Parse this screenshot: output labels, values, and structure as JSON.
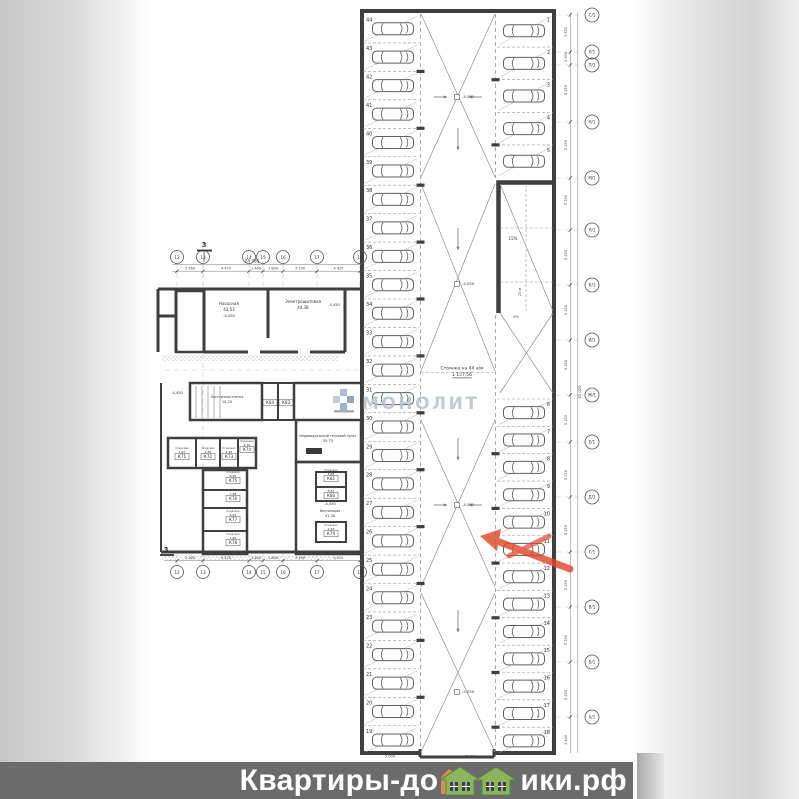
{
  "watermark": {
    "brand": "МОНОЛИТ"
  },
  "footer": {
    "site_prefix": "Квартиры-до",
    "site_suffix": "ики.рф",
    "site_name": "Квартиры-домики.рф"
  },
  "parking": {
    "caption": "Стоянка на 44 а/м",
    "caption_area": "1 157,56",
    "aisle_elevation": "-4,050",
    "left_stalls": [
      44,
      43,
      42,
      41,
      40,
      39,
      38,
      37,
      36,
      35,
      34,
      33,
      32,
      31,
      30,
      29,
      28,
      27,
      26,
      25,
      24,
      23,
      22,
      21,
      20,
      19
    ],
    "right_top_stalls": [
      1,
      2,
      3,
      4,
      5
    ],
    "right_bottom_stalls": [
      6,
      7,
      8,
      9,
      10,
      11,
      12,
      13,
      14,
      15,
      16,
      17,
      18
    ],
    "ramp": {
      "slope": "15%",
      "length": "23 м",
      "slope2": "9%"
    }
  },
  "rooms": [
    {
      "name": "Насосная",
      "area": "43,53",
      "x": 229,
      "y": 305,
      "small": false
    },
    {
      "name": "Электрощитовая",
      "area": "44,38",
      "x": 303,
      "y": 303,
      "small": false
    },
    {
      "name": "Индивидуальный тепловой пункт",
      "area": "55,75",
      "x": 328,
      "y": 437,
      "small": true
    },
    {
      "name": "Вентиляция",
      "area": "41,34",
      "x": 330,
      "y": 512,
      "small": true
    },
    {
      "name": "Лестничная клетка",
      "area": "15,25",
      "x": 227,
      "y": 398,
      "small": true
    }
  ],
  "storerooms": [
    {
      "id": "К71",
      "area": "1,97",
      "x": 182,
      "y": 457
    },
    {
      "id": "К72",
      "area": "2,36",
      "x": 208,
      "y": 457
    },
    {
      "id": "К73",
      "area": "2,25",
      "x": 229,
      "y": 457
    },
    {
      "id": "К74",
      "area": "4,76",
      "x": 247,
      "y": 450
    },
    {
      "id": "К75",
      "area": "6,95",
      "x": 233,
      "y": 481
    },
    {
      "id": "К76",
      "area": "7,48",
      "x": 233,
      "y": 499
    },
    {
      "id": "К77",
      "area": "6,93",
      "x": 233,
      "y": 520
    },
    {
      "id": "К78",
      "area": "7,48",
      "x": 233,
      "y": 543
    },
    {
      "id": "К79",
      "area": "2,32",
      "x": 331,
      "y": 534
    },
    {
      "id": "К80",
      "area": "3,45",
      "x": 331,
      "y": 496
    },
    {
      "id": "К81",
      "area": "5,28",
      "x": 331,
      "y": 479
    },
    {
      "id": "К83",
      "area": "",
      "x": 286,
      "y": 403
    },
    {
      "id": "К84",
      "area": "",
      "x": 270,
      "y": 403
    }
  ],
  "elevations": [
    {
      "t": "-4,450",
      "x": 229,
      "y": 317
    },
    {
      "t": "-4,450",
      "x": 334,
      "y": 306
    },
    {
      "t": "-4,450",
      "x": 330,
      "y": 505
    },
    {
      "t": "-4,450",
      "x": 177,
      "y": 394
    }
  ],
  "aisle_marks_y": [
    97,
    284,
    505,
    692
  ],
  "axes_h": {
    "labels": [
      "12",
      "13",
      "14",
      "15",
      "16",
      "17",
      "18"
    ],
    "x": [
      177,
      203,
      249,
      263,
      283,
      317,
      360
    ],
    "top_y": 257,
    "bottom_y": 572
  },
  "axes_right": {
    "x": 592,
    "items": [
      {
        "label": "С/1",
        "y": 15
      },
      {
        "label": "Р/1",
        "y": 52
      },
      {
        "label": "П/1",
        "y": 65
      },
      {
        "label": "Н/1",
        "y": 122
      },
      {
        "label": "М/1",
        "y": 178
      },
      {
        "label": "Л/1",
        "y": 230
      },
      {
        "label": "К/1",
        "y": 285
      },
      {
        "label": "И/1",
        "y": 340
      },
      {
        "label": "Ж/1",
        "y": 395
      },
      {
        "label": "Е/1",
        "y": 442
      },
      {
        "label": "Д/1",
        "y": 497
      },
      {
        "label": "Г/1",
        "y": 552
      },
      {
        "label": "В/1",
        "y": 607
      },
      {
        "label": "Б/1",
        "y": 662
      },
      {
        "label": "А/1",
        "y": 717
      }
    ]
  },
  "dims": {
    "top_total": "24 765",
    "segments": [
      "2 260",
      "4 470",
      "1 460",
      "1 800",
      "3 190",
      "4 425"
    ],
    "right_total": "51 025",
    "right_segments": [
      {
        "t": "3 525",
        "y": 32
      },
      {
        "t": "1 600",
        "y": 57
      },
      {
        "t": "5 250",
        "y": 90
      },
      {
        "t": "5 250",
        "y": 145
      },
      {
        "t": "5 250",
        "y": 200
      },
      {
        "t": "5 250",
        "y": 255
      },
      {
        "t": "5 250",
        "y": 310
      },
      {
        "t": "5 250",
        "y": 365
      },
      {
        "t": "5 250",
        "y": 420
      },
      {
        "t": "5 250",
        "y": 475
      },
      {
        "t": "5 250",
        "y": 530
      },
      {
        "t": "5 250",
        "y": 585
      },
      {
        "t": "5 250",
        "y": 640
      },
      {
        "t": "5 250",
        "y": 695
      },
      {
        "t": "3 440",
        "y": 740
      }
    ],
    "bottom_garage": [
      {
        "t": "5 000",
        "x": 390
      },
      {
        "t": "7 400",
        "x": 470
      }
    ]
  },
  "section_mark": "3"
}
